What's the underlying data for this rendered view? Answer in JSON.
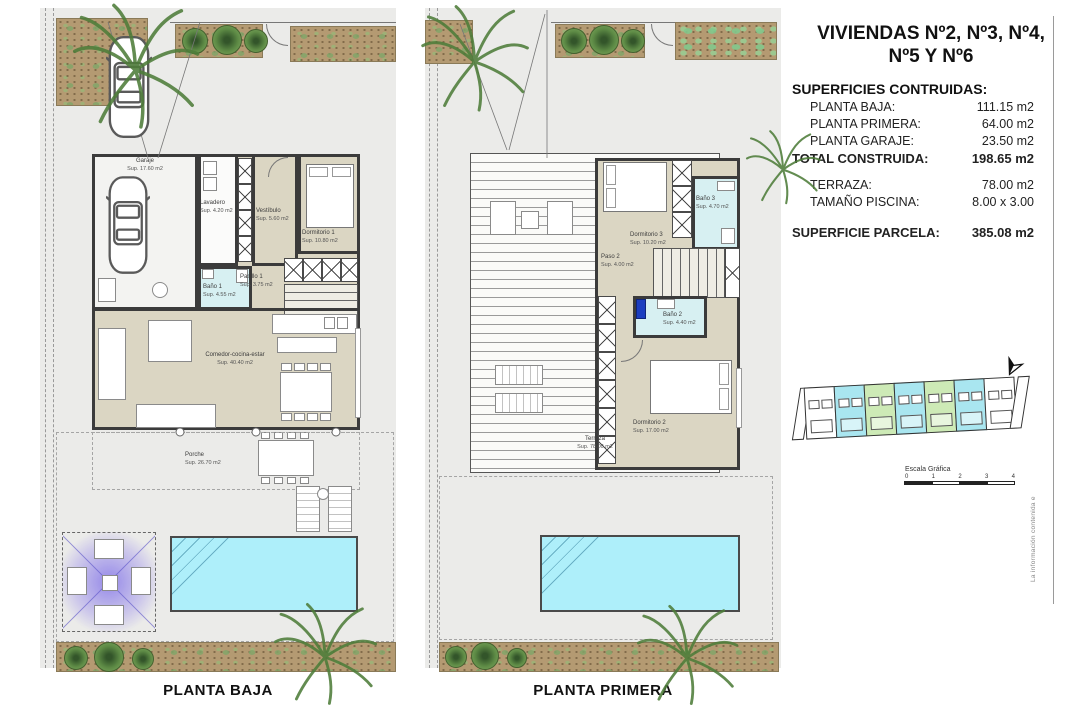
{
  "title_block": {
    "title_line1": "VIVIENDAS Nº2, Nº3, Nº4,",
    "title_line2": "Nº5 Y Nº6",
    "surfaces_heading": "SUPERFICIES CONTRUIDAS:",
    "rows": [
      {
        "label": "PLANTA BAJA:",
        "value": "111.15 m2"
      },
      {
        "label": "PLANTA PRIMERA:",
        "value": "64.00 m2"
      },
      {
        "label": "PLANTA GARAJE:",
        "value": "23.50 m2"
      }
    ],
    "total": {
      "label": "TOTAL CONSTRUIDA:",
      "value": "198.65 m2"
    },
    "extra_rows": [
      {
        "label": "TERRAZA:",
        "value": "78.00 m2"
      },
      {
        "label": "TAMAÑO PISCINA:",
        "value": "8.00 x 3.00"
      }
    ],
    "parcel": {
      "label": "SUPERFICIE PARCELA:",
      "value": "385.08 m2"
    }
  },
  "plans": {
    "ground": {
      "label": "PLANTA BAJA",
      "rooms": {
        "garaje": {
          "name": "Garaje",
          "area": "Sup. 17.60 m2"
        },
        "lavadero": {
          "name": "Lavadero",
          "area": "Sup. 4.20 m2"
        },
        "vestibulo": {
          "name": "Vestíbulo",
          "area": "Sup. 5.60 m2"
        },
        "dormitorio1": {
          "name": "Dormitorio 1",
          "area": "Sup. 10.80 m2"
        },
        "pasillo1": {
          "name": "Pasillo 1",
          "area": "Sup. 3.75 m2"
        },
        "bano1": {
          "name": "Baño 1",
          "area": "Sup. 4.55 m2"
        },
        "comedor": {
          "name": "Comedor-cocina-estar",
          "area": "Sup. 40.40 m2"
        },
        "porche": {
          "name": "Porche",
          "area": "Sup. 26.70 m2"
        }
      }
    },
    "first": {
      "label": "PLANTA PRIMERA",
      "rooms": {
        "dormitorio3": {
          "name": "Dormitorio 3",
          "area": "Sup. 10.20 m2"
        },
        "bano3": {
          "name": "Baño 3",
          "area": "Sup. 4.70 m2"
        },
        "paso2": {
          "name": "Paso 2",
          "area": "Sup. 4.00 m2"
        },
        "bano2": {
          "name": "Baño 2",
          "area": "Sup. 4.40 m2"
        },
        "dormitorio2": {
          "name": "Dormitorio 2",
          "area": "Sup. 17.00 m2"
        },
        "terraza": {
          "name": "Terraza",
          "area": "Sup. 78.00 m2"
        }
      }
    }
  },
  "site_plan": {
    "scale_label": "Escala Gráfica",
    "ticks": [
      "0",
      "1",
      "2",
      "3",
      "4"
    ],
    "unit_colors": [
      "#ffffff",
      "#a9e6f0",
      "#cdeab6",
      "#a9e6f0",
      "#cdeab6",
      "#a9e6f0",
      "#ffffff"
    ]
  },
  "side_note": "La información contenida e",
  "colors": {
    "wall": "#3b3b3b",
    "floor_beige": "#dbd6c3",
    "bath_cyan": "#d7f0f2",
    "pool_cyan": "#aeeffa",
    "garden_soil": "#b49a72",
    "pergola_purple": "#604ce8",
    "plan_background": "#ebebe9"
  }
}
